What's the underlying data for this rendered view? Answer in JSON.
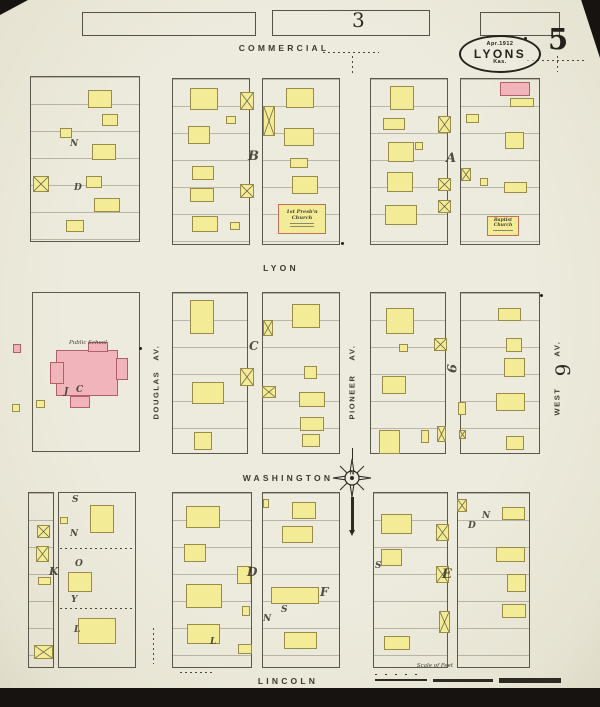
{
  "sheet": {
    "number": "5",
    "adjacent_top": "3",
    "adjacent_right": "6"
  },
  "stamp": {
    "line1": "Apr.1912",
    "line2": "LYONS",
    "line3": "Kas."
  },
  "streets": {
    "commercial": "COMMERCIAL",
    "lyon": "LYON",
    "washington": "WASHINGTON",
    "lincoln": "LINCOLN",
    "douglas": "DOUGLAS",
    "pioneer": "PIONEER",
    "west": "WEST",
    "av_suffix": "AV."
  },
  "labels": {
    "public_school": "Public School",
    "presb_church": "1st Presb'n Church",
    "baptist_church": "Baptist Church",
    "scale": "Scale of Feet"
  },
  "compass": {
    "north": "N"
  },
  "colors": {
    "paper": "#ebe8d9",
    "ink": "#2c2a22",
    "frame": "#f3eb96",
    "frame_border": "#998b4a",
    "brick": "#f0b4ba",
    "brick_border": "#b06068"
  },
  "map": {
    "adjacent_block_outlines": [
      {
        "x": 82,
        "y": 12,
        "w": 172,
        "h": 22
      },
      {
        "x": 272,
        "y": 10,
        "w": 156,
        "h": 24
      },
      {
        "x": 480,
        "y": 12,
        "w": 78,
        "h": 22
      }
    ],
    "blocks": [
      {
        "x": 30,
        "y": 76,
        "w": 110,
        "h": 166,
        "lots": 1
      },
      {
        "x": 172,
        "y": 78,
        "w": 78,
        "h": 167,
        "lots": 1
      },
      {
        "x": 262,
        "y": 78,
        "w": 78,
        "h": 167,
        "lots": 1
      },
      {
        "x": 370,
        "y": 78,
        "w": 78,
        "h": 167,
        "lots": 1
      },
      {
        "x": 460,
        "y": 78,
        "w": 80,
        "h": 167,
        "lots": 1
      },
      {
        "x": 32,
        "y": 292,
        "w": 108,
        "h": 160,
        "lots": 0
      },
      {
        "x": 172,
        "y": 292,
        "w": 76,
        "h": 162,
        "lots": 1
      },
      {
        "x": 262,
        "y": 292,
        "w": 78,
        "h": 162,
        "lots": 1
      },
      {
        "x": 370,
        "y": 292,
        "w": 76,
        "h": 162,
        "lots": 1
      },
      {
        "x": 460,
        "y": 292,
        "w": 80,
        "h": 162,
        "lots": 1
      },
      {
        "x": 28,
        "y": 492,
        "w": 26,
        "h": 176,
        "lots": 1
      },
      {
        "x": 58,
        "y": 492,
        "w": 78,
        "h": 176,
        "lots": 0
      },
      {
        "x": 172,
        "y": 492,
        "w": 80,
        "h": 176,
        "lots": 1
      },
      {
        "x": 262,
        "y": 492,
        "w": 78,
        "h": 176,
        "lots": 1
      },
      {
        "x": 373,
        "y": 492,
        "w": 75,
        "h": 176,
        "lots": 1
      },
      {
        "x": 457,
        "y": 492,
        "w": 73,
        "h": 176,
        "lots": 1
      }
    ],
    "buildings": [
      {
        "x": 88,
        "y": 90,
        "w": 24,
        "h": 18
      },
      {
        "x": 102,
        "y": 114,
        "w": 16,
        "h": 12
      },
      {
        "x": 60,
        "y": 128,
        "w": 12,
        "h": 10
      },
      {
        "x": 92,
        "y": 144,
        "w": 24,
        "h": 16
      },
      {
        "x": 86,
        "y": 176,
        "w": 16,
        "h": 12
      },
      {
        "x": 94,
        "y": 198,
        "w": 26,
        "h": 14
      },
      {
        "x": 66,
        "y": 220,
        "w": 18,
        "h": 12
      },
      {
        "x": 190,
        "y": 88,
        "w": 28,
        "h": 22
      },
      {
        "x": 188,
        "y": 126,
        "w": 22,
        "h": 18
      },
      {
        "x": 192,
        "y": 166,
        "w": 22,
        "h": 14
      },
      {
        "x": 190,
        "y": 188,
        "w": 24,
        "h": 14
      },
      {
        "x": 192,
        "y": 216,
        "w": 26,
        "h": 16
      },
      {
        "x": 226,
        "y": 116,
        "w": 10,
        "h": 8
      },
      {
        "x": 230,
        "y": 222,
        "w": 10,
        "h": 8
      },
      {
        "x": 286,
        "y": 88,
        "w": 28,
        "h": 20
      },
      {
        "x": 284,
        "y": 128,
        "w": 30,
        "h": 18
      },
      {
        "x": 290,
        "y": 158,
        "w": 18,
        "h": 10
      },
      {
        "x": 292,
        "y": 176,
        "w": 26,
        "h": 18
      },
      {
        "x": 278,
        "y": 204,
        "w": 48,
        "h": 30,
        "ch": 1
      },
      {
        "x": 390,
        "y": 86,
        "w": 24,
        "h": 24
      },
      {
        "x": 383,
        "y": 118,
        "w": 22,
        "h": 12
      },
      {
        "x": 388,
        "y": 142,
        "w": 26,
        "h": 20
      },
      {
        "x": 415,
        "y": 142,
        "w": 8,
        "h": 8
      },
      {
        "x": 387,
        "y": 172,
        "w": 26,
        "h": 20
      },
      {
        "x": 385,
        "y": 205,
        "w": 32,
        "h": 20
      },
      {
        "x": 500,
        "y": 82,
        "w": 30,
        "h": 14,
        "c": "b"
      },
      {
        "x": 510,
        "y": 98,
        "w": 24,
        "h": 9
      },
      {
        "x": 466,
        "y": 114,
        "w": 13,
        "h": 9
      },
      {
        "x": 505,
        "y": 132,
        "w": 19,
        "h": 17
      },
      {
        "x": 480,
        "y": 178,
        "w": 8,
        "h": 8
      },
      {
        "x": 504,
        "y": 182,
        "w": 23,
        "h": 11
      },
      {
        "x": 487,
        "y": 216,
        "w": 32,
        "h": 20,
        "ch": 1
      },
      {
        "x": 56,
        "y": 350,
        "w": 62,
        "h": 46,
        "c": "b"
      },
      {
        "x": 50,
        "y": 362,
        "w": 14,
        "h": 22,
        "c": "b"
      },
      {
        "x": 116,
        "y": 358,
        "w": 12,
        "h": 22,
        "c": "b"
      },
      {
        "x": 70,
        "y": 396,
        "w": 20,
        "h": 12,
        "c": "b"
      },
      {
        "x": 88,
        "y": 342,
        "w": 20,
        "h": 10,
        "c": "b"
      },
      {
        "x": 36,
        "y": 400,
        "w": 9,
        "h": 8
      },
      {
        "x": 13,
        "y": 344,
        "w": 8,
        "h": 9,
        "c": "b"
      },
      {
        "x": 12,
        "y": 404,
        "w": 8,
        "h": 8
      },
      {
        "x": 190,
        "y": 300,
        "w": 24,
        "h": 34
      },
      {
        "x": 192,
        "y": 382,
        "w": 32,
        "h": 22
      },
      {
        "x": 194,
        "y": 432,
        "w": 18,
        "h": 18
      },
      {
        "x": 292,
        "y": 304,
        "w": 28,
        "h": 24
      },
      {
        "x": 304,
        "y": 366,
        "w": 13,
        "h": 13
      },
      {
        "x": 299,
        "y": 392,
        "w": 26,
        "h": 15
      },
      {
        "x": 300,
        "y": 417,
        "w": 24,
        "h": 14
      },
      {
        "x": 302,
        "y": 434,
        "w": 18,
        "h": 13
      },
      {
        "x": 386,
        "y": 308,
        "w": 28,
        "h": 26
      },
      {
        "x": 399,
        "y": 344,
        "w": 9,
        "h": 8
      },
      {
        "x": 382,
        "y": 376,
        "w": 24,
        "h": 18
      },
      {
        "x": 379,
        "y": 430,
        "w": 21,
        "h": 24
      },
      {
        "x": 421,
        "y": 430,
        "w": 8,
        "h": 13
      },
      {
        "x": 498,
        "y": 308,
        "w": 23,
        "h": 13
      },
      {
        "x": 506,
        "y": 338,
        "w": 16,
        "h": 14
      },
      {
        "x": 504,
        "y": 358,
        "w": 21,
        "h": 19
      },
      {
        "x": 496,
        "y": 393,
        "w": 29,
        "h": 18
      },
      {
        "x": 506,
        "y": 436,
        "w": 18,
        "h": 14
      },
      {
        "x": 458,
        "y": 402,
        "w": 8,
        "h": 13
      },
      {
        "x": 38,
        "y": 577,
        "w": 13,
        "h": 8
      },
      {
        "x": 90,
        "y": 505,
        "w": 24,
        "h": 28
      },
      {
        "x": 60,
        "y": 517,
        "w": 8,
        "h": 7
      },
      {
        "x": 68,
        "y": 572,
        "w": 24,
        "h": 20
      },
      {
        "x": 78,
        "y": 618,
        "w": 38,
        "h": 26
      },
      {
        "x": 186,
        "y": 506,
        "w": 34,
        "h": 22
      },
      {
        "x": 184,
        "y": 544,
        "w": 22,
        "h": 18
      },
      {
        "x": 186,
        "y": 584,
        "w": 36,
        "h": 24
      },
      {
        "x": 187,
        "y": 624,
        "w": 33,
        "h": 20
      },
      {
        "x": 237,
        "y": 566,
        "w": 14,
        "h": 18
      },
      {
        "x": 242,
        "y": 606,
        "w": 8,
        "h": 10
      },
      {
        "x": 238,
        "y": 644,
        "w": 14,
        "h": 10
      },
      {
        "x": 292,
        "y": 502,
        "w": 24,
        "h": 17
      },
      {
        "x": 282,
        "y": 526,
        "w": 31,
        "h": 17
      },
      {
        "x": 271,
        "y": 587,
        "w": 48,
        "h": 17
      },
      {
        "x": 284,
        "y": 632,
        "w": 33,
        "h": 17
      },
      {
        "x": 263,
        "y": 499,
        "w": 6,
        "h": 9
      },
      {
        "x": 381,
        "y": 514,
        "w": 31,
        "h": 20
      },
      {
        "x": 381,
        "y": 549,
        "w": 21,
        "h": 17
      },
      {
        "x": 384,
        "y": 636,
        "w": 26,
        "h": 14
      },
      {
        "x": 502,
        "y": 507,
        "w": 23,
        "h": 13
      },
      {
        "x": 496,
        "y": 547,
        "w": 29,
        "h": 15
      },
      {
        "x": 507,
        "y": 574,
        "w": 19,
        "h": 18
      },
      {
        "x": 502,
        "y": 604,
        "w": 24,
        "h": 14
      }
    ],
    "stables": [
      {
        "x": 33,
        "y": 176,
        "w": 16,
        "h": 16
      },
      {
        "x": 240,
        "y": 92,
        "w": 14,
        "h": 18
      },
      {
        "x": 263,
        "y": 106,
        "w": 12,
        "h": 30
      },
      {
        "x": 240,
        "y": 184,
        "w": 14,
        "h": 14
      },
      {
        "x": 438,
        "y": 116,
        "w": 13,
        "h": 17
      },
      {
        "x": 438,
        "y": 178,
        "w": 13,
        "h": 13
      },
      {
        "x": 438,
        "y": 200,
        "w": 13,
        "h": 13
      },
      {
        "x": 461,
        "y": 168,
        "w": 10,
        "h": 13
      },
      {
        "x": 240,
        "y": 368,
        "w": 14,
        "h": 18
      },
      {
        "x": 262,
        "y": 386,
        "w": 14,
        "h": 12
      },
      {
        "x": 263,
        "y": 320,
        "w": 10,
        "h": 16
      },
      {
        "x": 434,
        "y": 338,
        "w": 13,
        "h": 13
      },
      {
        "x": 437,
        "y": 426,
        "w": 9,
        "h": 16
      },
      {
        "x": 459,
        "y": 430,
        "w": 7,
        "h": 9
      },
      {
        "x": 37,
        "y": 525,
        "w": 13,
        "h": 13
      },
      {
        "x": 36,
        "y": 546,
        "w": 13,
        "h": 16
      },
      {
        "x": 34,
        "y": 645,
        "w": 19,
        "h": 14
      },
      {
        "x": 436,
        "y": 524,
        "w": 13,
        "h": 17
      },
      {
        "x": 436,
        "y": 566,
        "w": 13,
        "h": 17
      },
      {
        "x": 439,
        "y": 611,
        "w": 11,
        "h": 22
      },
      {
        "x": 457,
        "y": 499,
        "w": 10,
        "h": 13
      }
    ],
    "letters": [
      {
        "t": "B",
        "x": 248,
        "y": 150,
        "s": 13
      },
      {
        "t": "A",
        "x": 446,
        "y": 152,
        "s": 13
      },
      {
        "t": "C",
        "x": 249,
        "y": 340,
        "s": 12
      },
      {
        "t": "9",
        "x": 446,
        "y": 362,
        "s": 13,
        "r": 90
      },
      {
        "t": "D",
        "x": 247,
        "y": 566,
        "s": 12
      },
      {
        "t": "F",
        "x": 320,
        "y": 586,
        "s": 12
      },
      {
        "t": "E",
        "x": 442,
        "y": 568,
        "s": 13
      },
      {
        "t": "K",
        "x": 49,
        "y": 566,
        "s": 11
      },
      {
        "t": "S",
        "x": 72,
        "y": 496,
        "s": 9
      },
      {
        "t": "N",
        "x": 70,
        "y": 530,
        "s": 9
      },
      {
        "t": "O",
        "x": 75,
        "y": 560,
        "s": 9
      },
      {
        "t": "Y",
        "x": 71,
        "y": 596,
        "s": 9
      },
      {
        "t": "L",
        "x": 74,
        "y": 626,
        "s": 9
      },
      {
        "t": "L",
        "x": 210,
        "y": 638,
        "s": 9
      },
      {
        "t": "S",
        "x": 281,
        "y": 606,
        "s": 9
      },
      {
        "t": "N",
        "x": 263,
        "y": 615,
        "s": 9
      },
      {
        "t": "D",
        "x": 468,
        "y": 522,
        "s": 9
      },
      {
        "t": "N",
        "x": 482,
        "y": 512,
        "s": 9
      },
      {
        "t": "S",
        "x": 375,
        "y": 562,
        "s": 9
      },
      {
        "t": "N",
        "x": 70,
        "y": 140,
        "s": 9
      },
      {
        "t": "D",
        "x": 74,
        "y": 184,
        "s": 9
      },
      {
        "t": "J",
        "x": 64,
        "y": 388,
        "s": 9
      },
      {
        "t": "C",
        "x": 76,
        "y": 386,
        "s": 9
      }
    ],
    "dots": [
      {
        "x": 341,
        "y": 242
      },
      {
        "x": 524,
        "y": 37
      },
      {
        "x": 139,
        "y": 347
      },
      {
        "x": 540,
        "y": 294
      }
    ],
    "dotted_lines": [
      {
        "x": 527,
        "y": 60,
        "w": 58,
        "h": 1
      },
      {
        "x": 323,
        "y": 52,
        "w": 56,
        "h": 1
      },
      {
        "x": 557,
        "y": 56,
        "w": 1,
        "h": 16
      },
      {
        "x": 352,
        "y": 56,
        "w": 1,
        "h": 18
      },
      {
        "x": 60,
        "y": 548,
        "w": 73,
        "h": 1
      },
      {
        "x": 60,
        "y": 608,
        "w": 73,
        "h": 1
      },
      {
        "x": 153,
        "y": 628,
        "w": 1,
        "h": 36
      },
      {
        "x": 180,
        "y": 672,
        "w": 34,
        "h": 1
      }
    ]
  }
}
